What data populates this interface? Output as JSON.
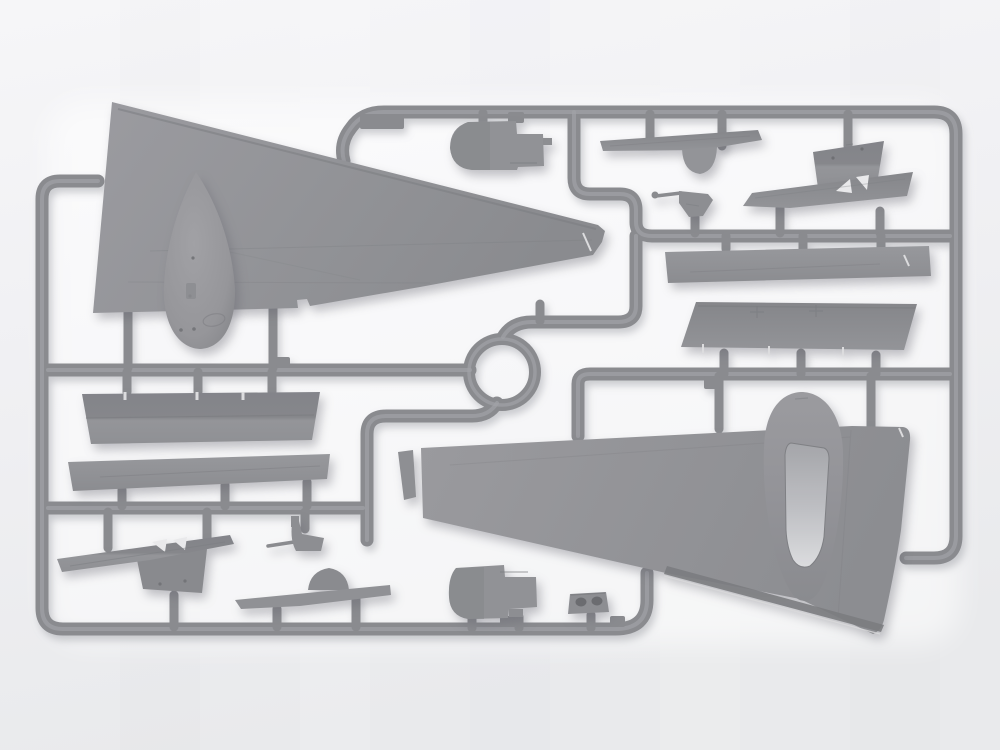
{
  "scene": {
    "type": "photograph",
    "subject": "Gray injection-molded plastic model kit sprue with aircraft parts",
    "orientation": "landscape",
    "text_visible": "none"
  },
  "colors": {
    "bg-top": "#f6f6f8",
    "bg-bottom": "#e9eaec",
    "glow": "#ffffff",
    "plastic": "#909195",
    "plastic-light": "#a2a3a7",
    "plastic-dark": "#7c7d81",
    "runner": "#8a8b8f",
    "runner-highlight": "#a1a2a6",
    "cutout": "#e9e9eb",
    "hole": "#6b6c70",
    "canopy": "#dedfe1"
  },
  "parts": {
    "frame": "sprue runner frame",
    "ring": "circular runner ring",
    "upper_wing": "large upper wing panel (top left)",
    "nose_cone": "nose cone spinner",
    "cowl_top": "engine cowling half (top center)",
    "cowl_bottom": "engine cowling half (bottom center)",
    "trapezoid_panel": "fuselage side panel with notches",
    "long_strake": "long leading-edge strip",
    "stabilizer": "tailplane with fin and strut cutouts",
    "gun_bottom": "machine gun (bottom left)",
    "gun_top": "machine gun with barrel (center right)",
    "hump_strip": "spine strip with dome fairing",
    "holes_block": "bracket with two openings",
    "tailplane_top": "tailplane with round fairing (top center)",
    "flap_panel": "angled flap panel (top right)",
    "slatted_panel": "long panel with triangular cutouts",
    "plank": "long spar strip (right)",
    "wide_panel": "center-section panel (right)",
    "lower_wing": "large lower wing with engine nacelle and canopy opening",
    "wing_tip_sliver": "separate wing tip strip"
  }
}
